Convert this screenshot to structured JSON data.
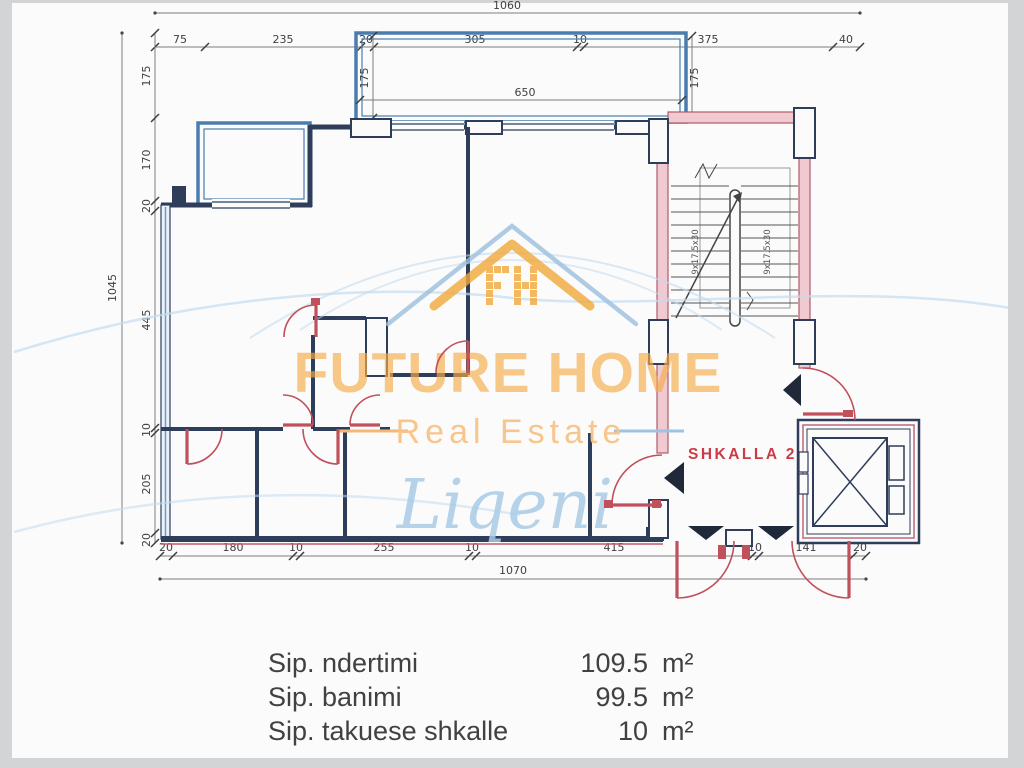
{
  "watermark": {
    "brand": "FUTURE HOME",
    "tagline": "Real Estate",
    "script": "Liqeni",
    "monogram": "FH"
  },
  "plan": {
    "room_label": "SHKALLA 2",
    "room_label_color": "#cc3b45",
    "stair_flight_label": "9x17.5x30",
    "dims": {
      "top_total": "1060",
      "top_segments": [
        "75",
        "235",
        "20",
        "305",
        "10",
        "375",
        "40"
      ],
      "left_total": "1045",
      "left_segments": [
        "175",
        "170",
        "20",
        "445",
        "10",
        "205",
        "20"
      ],
      "bottom_total": "1070",
      "bottom_segments": [
        "20",
        "180",
        "10",
        "255",
        "10",
        "415",
        "10",
        "141",
        "20"
      ],
      "balcony_depth_left": "175",
      "balcony_width": "650",
      "balcony_depth_right": "175"
    },
    "colors": {
      "wall": "#2e3d59",
      "stair_wall": "#b05a6a",
      "door": "#c0505c",
      "balcony_border": "#4a7dae",
      "dimension": "#3f3f3f",
      "accent_orange": "#f2a93b",
      "accent_blue": "#9dc0de"
    }
  },
  "summary": {
    "rows": [
      {
        "label": "Sip. ndertimi",
        "value": "109.5",
        "unit": "m²"
      },
      {
        "label": "Sip. banimi",
        "value": "99.5",
        "unit": "m²"
      },
      {
        "label": "Sip. takuese shkalle",
        "value": "10",
        "unit": "m²"
      }
    ]
  }
}
